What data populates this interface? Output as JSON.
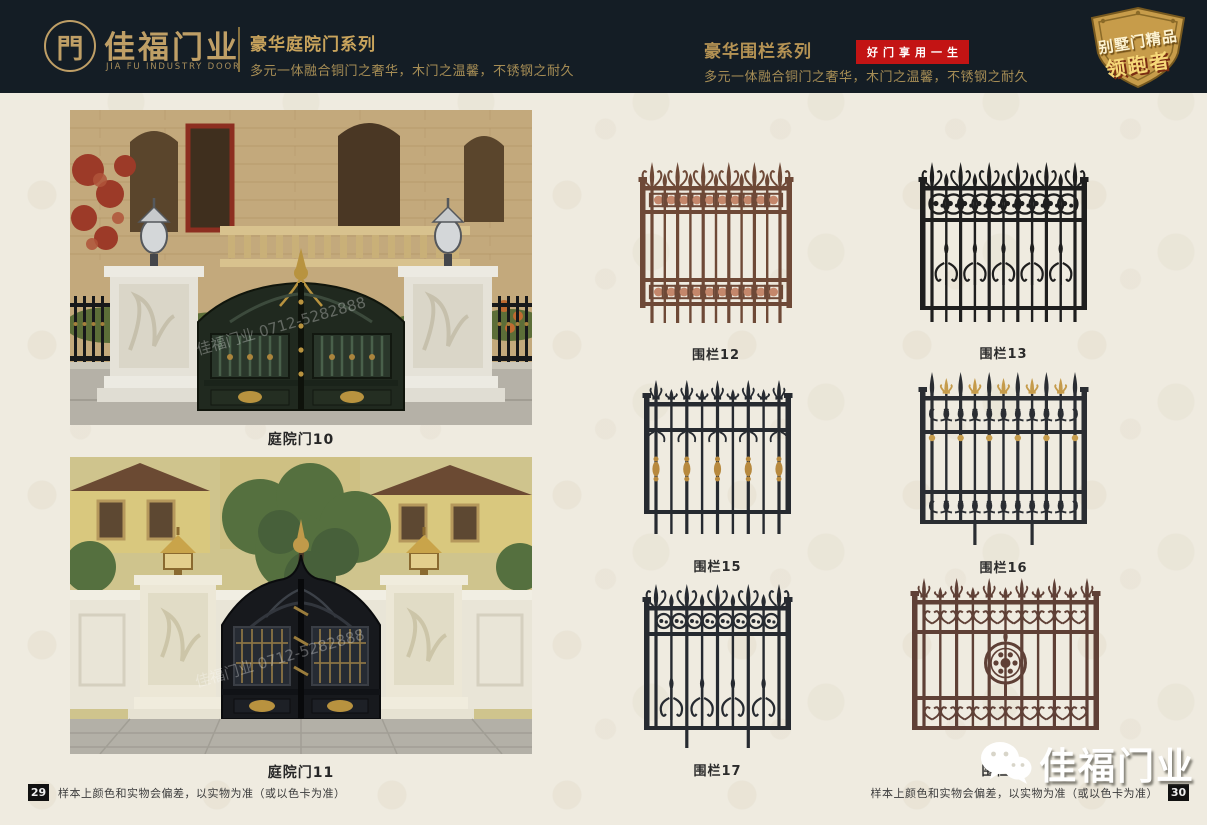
{
  "page": {
    "bg_color": "#efebe0",
    "header_bg": "#141d25",
    "gold": "#bf9f66",
    "red": "#c31414"
  },
  "header": {
    "brand": {
      "logo_glyph": "門",
      "name_cn": "佳福门业",
      "name_en": "JIA FU INDUSTRY DOOR"
    },
    "door_series": {
      "title": "豪华庭院门系列",
      "subtitle": "多元一体融合铜门之奢华，木门之温馨，不锈钢之耐久"
    },
    "fence_series": {
      "title": "豪华围栏系列",
      "badge": "好门享用一生",
      "subtitle": "多元一体融合铜门之奢华，木门之温馨，不锈钢之耐久"
    },
    "shield_badge": {
      "line1": "别墅门精品",
      "line2": "领跑者"
    }
  },
  "left_page": {
    "photos": [
      {
        "caption": "庭院门10",
        "watermark": "佳福门业 0712-5282888"
      },
      {
        "caption": "庭院门11",
        "watermark": "佳福门业 0712-5282888"
      }
    ],
    "page_number": "29",
    "disclaimer": "样本上颜色和实物会偏差，以实物为准（或以色卡为准）"
  },
  "right_page": {
    "fences": [
      {
        "caption": "围栏12",
        "color": "#6e4937",
        "accent": "#c4876b"
      },
      {
        "caption": "围栏13",
        "color": "#1e1e1e",
        "accent": "#1e1e1e"
      },
      {
        "caption": "围栏15",
        "color": "#262a30",
        "accent": "#b7893e"
      },
      {
        "caption": "围栏16",
        "color": "#2a2d32",
        "accent": "#c59b4b"
      },
      {
        "caption": "围栏17",
        "color": "#262a30",
        "accent": "#262a30"
      },
      {
        "caption": "围栏18",
        "color": "#5f4036",
        "accent": "#5f4036"
      }
    ],
    "page_number": "30",
    "disclaimer": "样本上颜色和实物会偏差，以实物为准（或以色卡为准）",
    "brand_watermark": "佳福门业"
  }
}
